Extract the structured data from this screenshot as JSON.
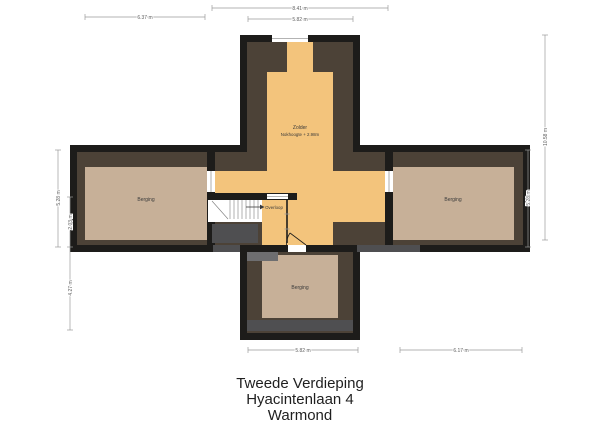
{
  "title": {
    "line1": "Tweede Verdieping",
    "line2": "Hyacintenlaan 4",
    "line3": "Warmond"
  },
  "plan": {
    "labels": {
      "zolder": "Zolder",
      "zolder_sub": "Nokhoogte + 2.98m",
      "berging_left": "Berging",
      "berging_right": "Berging",
      "berging_bottom": "Berging",
      "overloop": "Overloop"
    },
    "dimensions": {
      "top_outer": "8.41 m",
      "top_inner": "5.82 m",
      "top_left": "6.37 m",
      "bottom_center": "5.82 m",
      "bottom_right": "6.17 m",
      "left_outer": "5.28 m",
      "left_inner_upper": "2.03 m",
      "left_inner_lower": "4.27 m",
      "right_inner": "5.28 m",
      "right_outer": "10.58 m"
    },
    "colors": {
      "wall": "#1d1c1a",
      "roof": "#4c4237",
      "attic_floor": "#f3c47c",
      "storage_floor": "#c7b098",
      "void_dark": "#4f4f51",
      "void_medium": "#6e6e70",
      "window_white": "#ffffff"
    }
  }
}
